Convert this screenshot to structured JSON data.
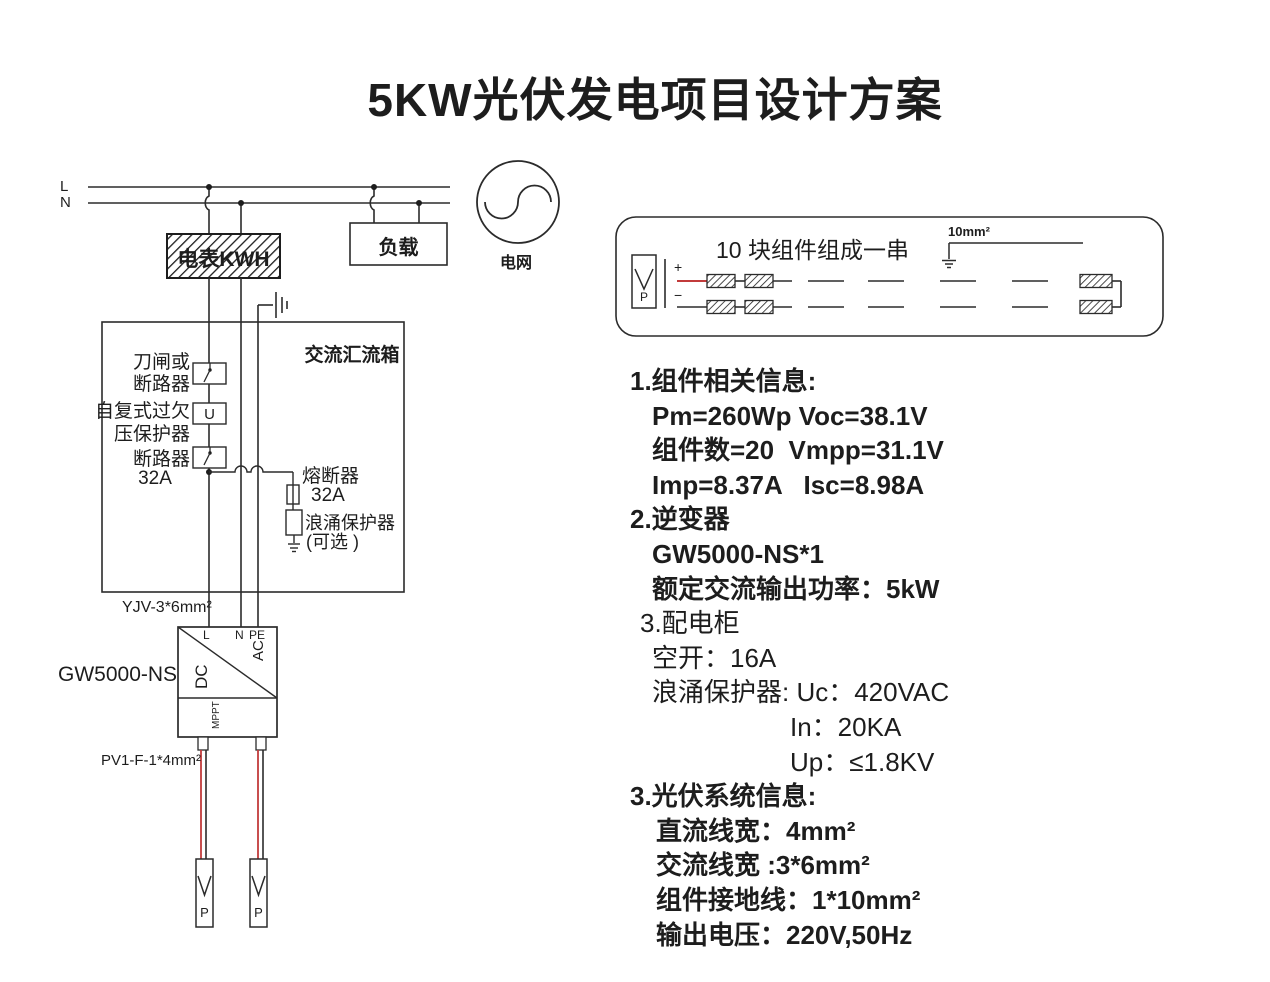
{
  "title": "5KW光伏发电项目设计方案",
  "colors": {
    "ink": "#1d1d1d",
    "wire_red": "#c23b3b"
  },
  "schematic": {
    "line_l": "L",
    "line_n": "N",
    "meter": "电表KWH",
    "load": "负载",
    "grid": "电网",
    "combiner_title": "交流汇流箱",
    "knife_switch_line1": "刀闸或",
    "knife_switch_line2": "断路器",
    "uvp_line1": "自复式过欠",
    "uvp_line2": "压保护器",
    "uvp_symbol": "U",
    "breaker_line1": "断路器",
    "breaker_line2": "32A",
    "fuse_line1": "熔断器",
    "fuse_line2": "32A",
    "spd_line1": "浪涌保护器",
    "spd_line2": "(可选 )",
    "ac_cable": "YJV-3*6mm²",
    "inverter_model": "GW5000-NS",
    "term_l": "L",
    "term_n": "N",
    "term_pe": "PE",
    "dc": "DC",
    "ac": "AC",
    "mppt": "MPPT",
    "dc_cable": "PV1-F-1*4mm²",
    "connector_p_left": "P",
    "connector_p_right": "P"
  },
  "string_box": {
    "title": "10 块组件组成一串",
    "ground_wire": "10mm²",
    "plus": "+",
    "minus": "−",
    "connector_p": "P"
  },
  "info": {
    "lines": [
      {
        "text": "1.组件相关信息:",
        "bold": true,
        "indent": "h"
      },
      {
        "text": "Pm=260Wp Voc=38.1V",
        "bold": true,
        "indent": "sub"
      },
      {
        "text": "组件数=20  Vmpp=31.1V",
        "bold": true,
        "indent": "sub"
      },
      {
        "text": "Imp=8.37A   Isc=8.98A",
        "bold": true,
        "indent": "sub"
      },
      {
        "text": "2.逆变器",
        "bold": true,
        "indent": "h"
      },
      {
        "text": "GW5000-NS*1",
        "bold": true,
        "indent": "sub"
      },
      {
        "text": "额定交流输出功率：5kW",
        "bold": true,
        "indent": "sub"
      },
      {
        "text": "3.配电柜",
        "bold": false,
        "indent": "small"
      },
      {
        "text": "空开：16A",
        "bold": false,
        "indent": "sub"
      },
      {
        "text": "浪涌保护器: Uc：420VAC",
        "bold": false,
        "indent": "sub"
      },
      {
        "text": "In：20KA",
        "bold": false,
        "indent": "deep"
      },
      {
        "text": "Up：≤1.8KV",
        "bold": false,
        "indent": "deep"
      },
      {
        "text": "3.光伏系统信息:",
        "bold": true,
        "indent": "h"
      },
      {
        "text": "直流线宽：4mm²",
        "bold": true,
        "indent": "s3"
      },
      {
        "text": "交流线宽 :3*6mm²",
        "bold": true,
        "indent": "s3"
      },
      {
        "text": "组件接地线：1*10mm²",
        "bold": true,
        "indent": "s3"
      },
      {
        "text": "输出电压：220V,50Hz",
        "bold": true,
        "indent": "s3"
      }
    ]
  }
}
